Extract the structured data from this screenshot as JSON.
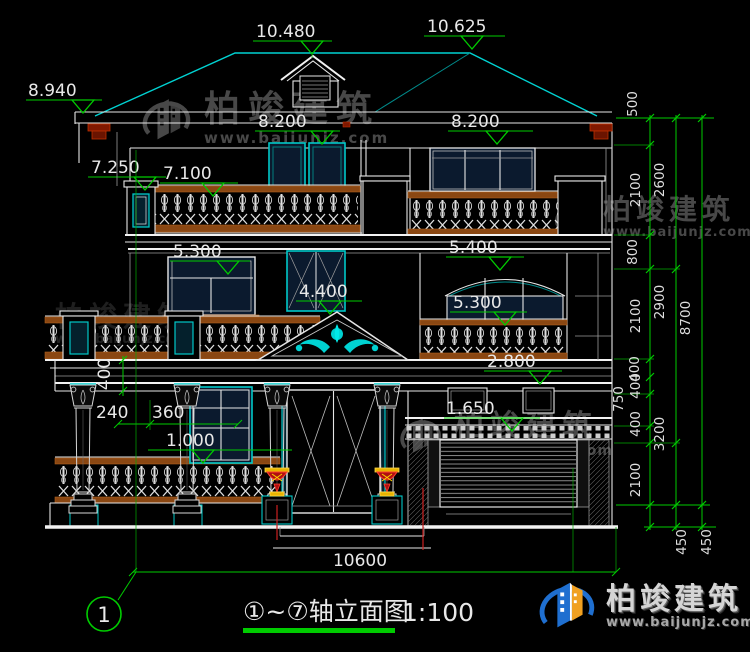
{
  "colors": {
    "background": "#000000",
    "line_white": "#e6e6e6",
    "line_cyan": "#00d2d2",
    "dimension_green": "#00cc00",
    "rail_brown": "#8a4712",
    "corbel_red": "#8b2500",
    "urn_red": "#b01010",
    "urn_yellow": "#e8b400",
    "axis_red": "#cc2020",
    "logo_blue": "#1f6fd0",
    "logo_orange": "#f0a020",
    "watermark_gray": "#8f8f8f"
  },
  "levels": {
    "top_left": "10.480",
    "top_right": "10.625",
    "eave_left": "8.940",
    "floor3_left": "8.200",
    "floor3_right": "8.200",
    "balcony_pillar": "7.250",
    "balcony_rail": "7.100",
    "floor2_left": "5.300",
    "pediment": "4.400",
    "floor2_right_top": "5.400",
    "floor2_right": "5.300",
    "railing_right": "2.800",
    "garage_lintel": "1.650",
    "porch_floor": "1.000"
  },
  "dims": {
    "cornice_height": "400",
    "col_offset": "240",
    "col_spacing": "360",
    "total_width": "10600",
    "right_inner": [
      "500",
      "2100",
      "800",
      "2100",
      "400",
      "400",
      "750",
      "400",
      "2100"
    ],
    "right_mid": [
      "2600",
      "2900",
      "3200"
    ],
    "right_total": "8700",
    "below_grade": [
      "450",
      "450"
    ]
  },
  "title": {
    "axis_bubble": "1",
    "text": "①~⑦轴立面图",
    "scale": "1:100"
  },
  "watermark": {
    "brand": "柏竣建筑",
    "url": "www.baijunjz.com"
  },
  "logo": {
    "brand": "柏竣建筑",
    "url": "www.baijunjz.com"
  }
}
